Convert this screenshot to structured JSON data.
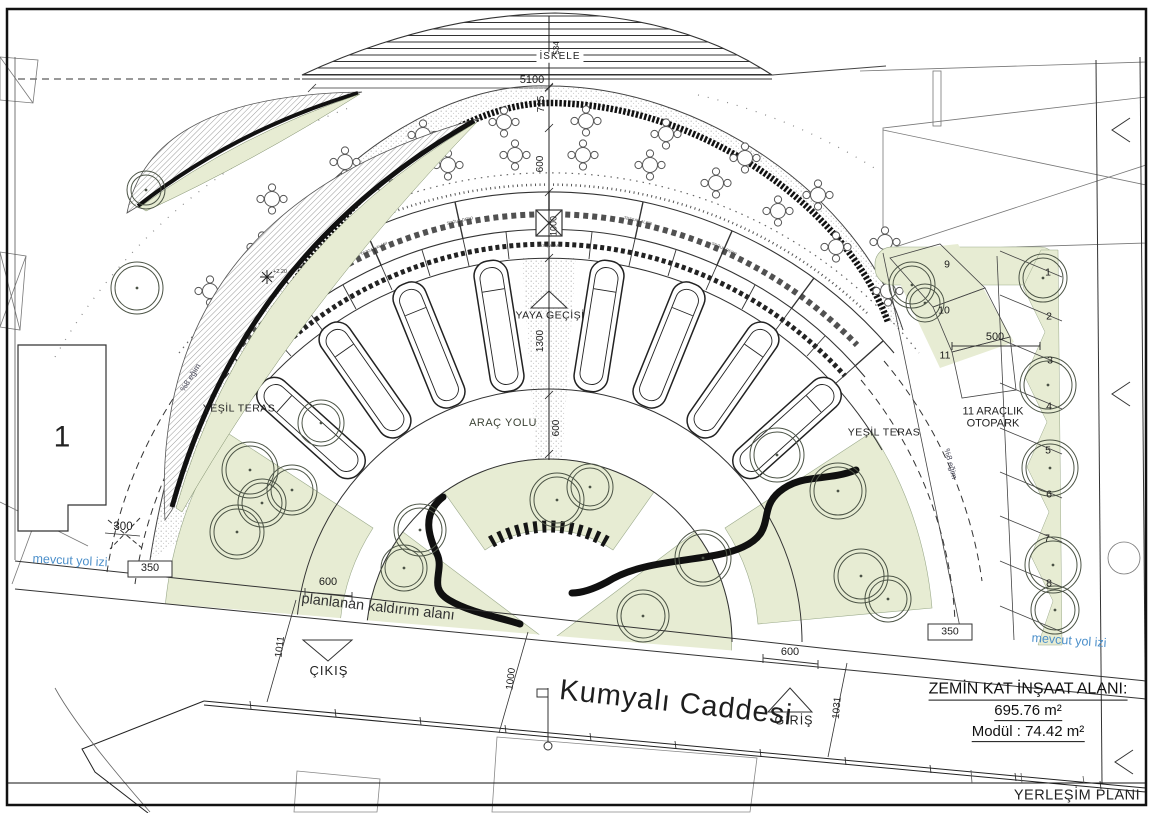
{
  "drawing": {
    "plan_title": "YERLEŞİM PLANI",
    "area_block": {
      "title": "ZEMİN KAT İNŞAAT ALANI:",
      "area": "695.76 m²",
      "module": "Modül : 74.42 m²"
    },
    "street": {
      "name": "Kumyalı Caddesi",
      "entrance": "GİRİŞ",
      "exit": "ÇIKIŞ",
      "sidewalk_label": "planlanan kaldırım alanı",
      "existing_road_left": "mevcut yol izi",
      "existing_road_right": "mevcut yol izi"
    },
    "labels": {
      "pier": "İSKELE",
      "pedestrian_crossing": "YAYA GEÇİŞİ",
      "vehicle_road": "ARAÇ YOLU",
      "green_terrace_left": "YEŞİL TERAS",
      "green_terrace_right": "YEŞİL TERAS",
      "parking_area": "11 ARAÇLIK OTOPARK",
      "slope_left": "%8 eğim",
      "slope_right": "%8 eğim",
      "block_number": "1",
      "spot_elevation": "+2.20"
    },
    "module_labels": {
      "cold_storage": "SOĞUK DEPO",
      "counter_area": "TEZGAH ALANI",
      "sales_area": "SATIŞ ALANI"
    },
    "dimensions": {
      "pier_width": "5100",
      "pier_depth": "534",
      "d715": "715",
      "d600_tables": "600",
      "d1000_modules": "1000",
      "d1300_crossing": "1300",
      "d600_road": "600",
      "d300": "300",
      "d350_left": "350",
      "d350_right": "350",
      "d500_parking": "500",
      "d600_sidewalk_left": "600",
      "d600_sidewalk_right": "600",
      "d1011": "1011",
      "d1000_street": "1000",
      "d1031": "1031"
    },
    "parking_stalls": [
      "1",
      "2",
      "3",
      "4",
      "5",
      "6",
      "7",
      "8",
      "9",
      "10",
      "11"
    ]
  }
}
